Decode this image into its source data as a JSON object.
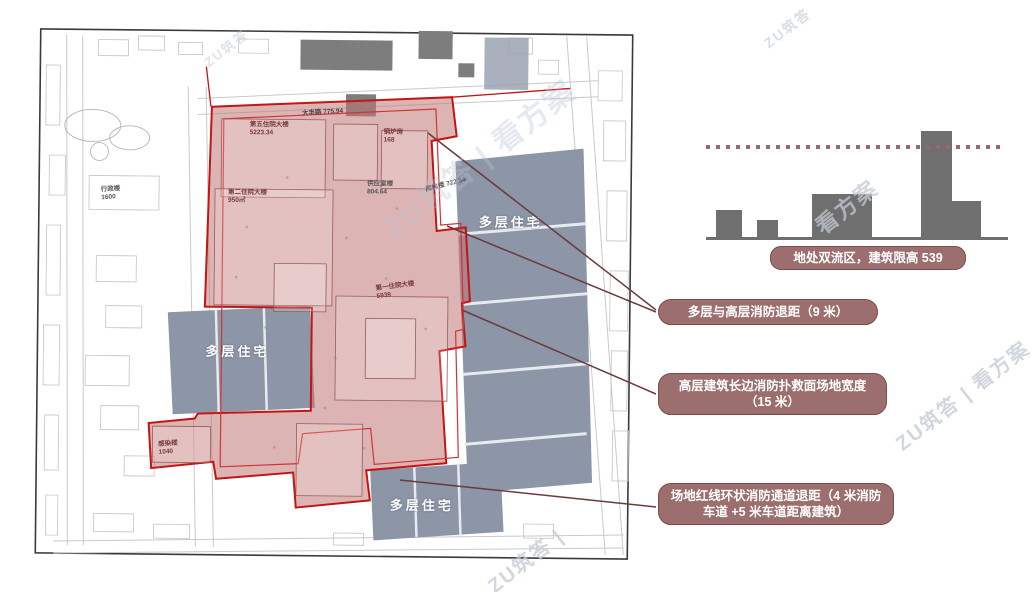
{
  "map": {
    "road_label": "大丰路 775.94",
    "buildings": [
      {
        "label": "第五住院大楼\n5223.34"
      },
      {
        "label": "第二住院大楼\n950㎡"
      },
      {
        "label": "行政楼\n1600"
      },
      {
        "label": "锅炉房\n168"
      },
      {
        "label": "供应室楼\n804.64"
      },
      {
        "label": "库房楼 722.54"
      },
      {
        "label": "第一住院大楼\n5939"
      },
      {
        "label": "感染楼\n1040"
      }
    ],
    "residential": [
      "多层住宅",
      "多层住宅",
      "多层住宅"
    ]
  },
  "skyline": {
    "caption": "地处双流区，建筑限高 539",
    "bars": [
      {
        "x": 10,
        "w": 26,
        "h": 27
      },
      {
        "x": 51,
        "w": 21,
        "h": 17
      },
      {
        "x": 106,
        "w": 60,
        "h": 43
      },
      {
        "x": 215,
        "w": 31,
        "h": 106
      },
      {
        "x": 246,
        "w": 29,
        "h": 36
      }
    ],
    "limit_line_offset": 93
  },
  "callouts": [
    {
      "text": "多层与高层消防退距（9 米）"
    },
    {
      "text": "高层建筑长边消防扑救面场地宽度（15 米）"
    },
    {
      "text": "场地红线环状消防通道退距（4 米消防车道 +5 米车道距离建筑）"
    }
  ],
  "watermarks": [
    "ZU筑答 | 看方案",
    "看方案",
    "ZU筑答 | 看方案",
    "ZU筑答 |",
    "ZU筑答",
    "ZU筑答 | 看方案"
  ],
  "colors": {
    "site_fill": "#c17676",
    "site_line": "#c41414",
    "residential_fill": "#8c96a7",
    "bar_gray": "#6f6f6f",
    "pill": "#9c6e6e",
    "leader": "#6b3a3a",
    "limit_dash": "#96686a"
  }
}
